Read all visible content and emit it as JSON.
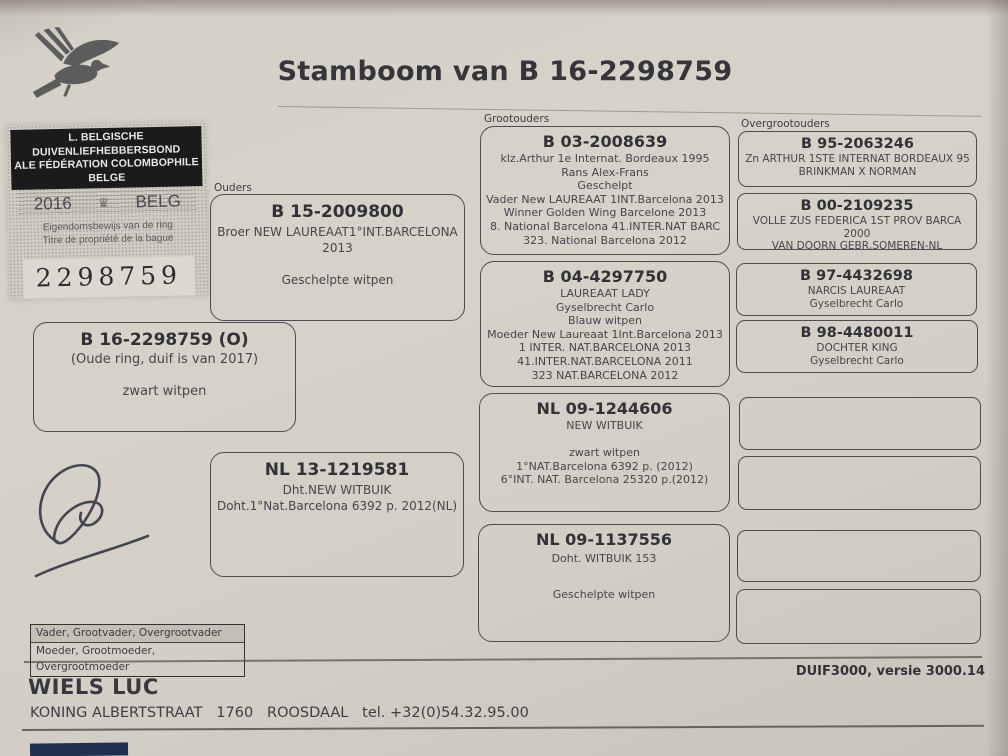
{
  "title": "Stamboom van B 16-2298759",
  "ring_stamp": {
    "header_line1": "L. BELGISCHE DUIVENLIEFHEBBERSBOND",
    "header_line2": "ALE FÉDÉRATION COLOMBOPHILE BELGE",
    "year": "2016",
    "country": "BELG",
    "crown_icon": "♛",
    "ownership_line1": "Eigendomsbewijs van de ring",
    "ownership_line2": "Titre de propriété de la bague",
    "ring_number": "2298759"
  },
  "section_labels": {
    "ouders": "Ouders",
    "grootouders": "Grootouders",
    "overgrootouders": "Overgrootouders"
  },
  "subject": {
    "ring": "B 16-2298759 (O)",
    "lines": [
      "(Oude ring, duif is van 2017)",
      "",
      "zwart witpen"
    ]
  },
  "father": {
    "ring": "B 15-2009800",
    "lines": [
      "Broer NEW LAUREAAT1°INT.BARCELONA 2013",
      "",
      "Geschelpte witpen"
    ]
  },
  "mother": {
    "ring": "NL 13-1219581",
    "lines": [
      "Dht.NEW WITBUIK",
      "Doht.1°Nat.Barcelona 6392 p. 2012(NL)"
    ]
  },
  "grandparents": [
    {
      "ring": "B 03-2008639",
      "lines": [
        "klz.Arthur 1e Internat. Bordeaux 1995",
        "Rans Alex-Frans",
        "Geschelpt",
        "Vader New LAUREAAT 1INT.Barcelona 2013",
        "Winner Golden Wing Barcelone 2013",
        "8. National Barcelona 41.INTER.NAT BARC",
        "323. National Barcelona 2012"
      ]
    },
    {
      "ring": "B 04-4297750",
      "lines": [
        "LAUREAAT LADY",
        "Gyselbrecht Carlo",
        "Blauw witpen",
        "Moeder New Laureaat 1Int.Barcelona 2013",
        "1 INTER. NAT.BARCELONA 2013",
        "41.INTER.NAT.BARCELONA 2011",
        "323 NAT.BARCELONA 2012"
      ]
    },
    {
      "ring": "NL 09-1244606",
      "lines": [
        "NEW WITBUIK",
        "",
        "zwart witpen",
        "1°NAT.Barcelona 6392 p. (2012)",
        "6°INT. NAT. Barcelona 25320 p.(2012)"
      ]
    },
    {
      "ring": "NL 09-1137556",
      "lines": [
        "Doht. WITBUIK 153",
        "",
        "Geschelpte witpen"
      ]
    }
  ],
  "greatgrandparents": [
    {
      "ring": "B 95-2063246",
      "lines": [
        "Zn ARTHUR 1STE INTERNAT BORDEAUX 95",
        "BRINKMAN X NORMAN"
      ]
    },
    {
      "ring": "B 00-2109235",
      "lines": [
        "VOLLE ZUS FEDERICA 1ST PROV BARCA 2000",
        "VAN DOORN GEBR,SOMEREN-NL"
      ]
    },
    {
      "ring": "B 97-4432698",
      "lines": [
        "NARCIS LAUREAAT",
        "Gyselbrecht Carlo"
      ]
    },
    {
      "ring": "B 98-4480011",
      "lines": [
        "DOCHTER KING",
        "Gyselbrecht Carlo"
      ]
    }
  ],
  "legend": {
    "row1": "Vader, Grootvader, Overgrootvader",
    "row2": "Moeder, Grootmoeder, Overgrootmoeder"
  },
  "software": "DUIF3000, versie 3000.14",
  "footer": {
    "name": "WIELS LUC",
    "address": "KONING ALBERTSTRAAT   1760   ROOSDAAL   tel. +32(0)54.32.95.00"
  }
}
